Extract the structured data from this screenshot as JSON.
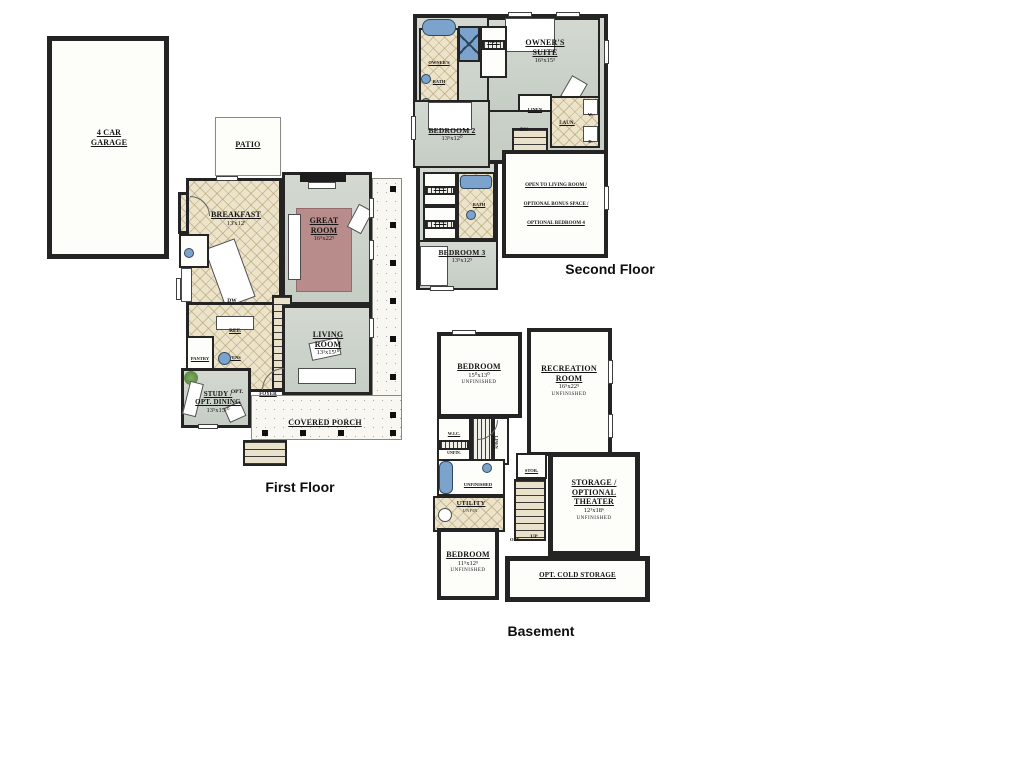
{
  "palette": {
    "wall": "#242424",
    "room_green": "#ccd3cb",
    "tile_tan": "#ece3cb",
    "rug_mauve": "#b98c8c",
    "fixture_blue": "#7ba3cc",
    "porch": "#f8f7f2"
  },
  "floors": {
    "first": {
      "title": "First Floor",
      "rooms": {
        "garage": {
          "name": "4 CAR",
          "name2": "GARAGE"
        },
        "patio": {
          "name": "PATIO"
        },
        "mud": {
          "name": "MUD"
        },
        "breakfast": {
          "name": "BREAKFAST",
          "dims": "13'x12'"
        },
        "great_room": {
          "name": "GREAT",
          "name2": "ROOM",
          "dims": "16⁵x22⁵"
        },
        "living_room": {
          "name": "LIVING",
          "name2": "ROOM",
          "dims": "13¹x15¹⁰"
        },
        "study": {
          "name": "STUDY /",
          "name2": "OPT. DINING",
          "dims": "13⁵x15¹⁰"
        },
        "covered_porch": {
          "name": "COVERED PORCH"
        },
        "foyer": {
          "name": "FOYER"
        },
        "pantry": {
          "name": "PANTRY"
        },
        "ovens": {
          "name": "OVENS"
        },
        "ref": {
          "name": "REF."
        },
        "dw": {
          "name": "DW"
        },
        "opt_door": {
          "name": "OPT."
        }
      }
    },
    "second": {
      "title": "Second Floor",
      "rooms": {
        "owners_suite": {
          "name": "OWNER'S",
          "name2": "SUITE",
          "dims": "16⁵x15⁵"
        },
        "owners_bath": {
          "name": "OWNER'S",
          "name2": "BATH"
        },
        "wic": {
          "name": "W.I.C."
        },
        "bedroom2": {
          "name": "BEDROOM 2",
          "dims": "13⁵x12⁰"
        },
        "bath": {
          "name": "BATH"
        },
        "bedroom3": {
          "name": "BEDROOM 3",
          "dims": "13⁵x12⁵"
        },
        "linen": {
          "name": "LINEN"
        },
        "laundry": {
          "name": "LAUN.",
          "washer": "W.",
          "dryer": "D."
        },
        "stairs_dn": {
          "name": "DN"
        },
        "bonus_note": {
          "line1": "OPEN TO LIVING ROOM /",
          "line2": "OPTIONAL BONUS SPACE /",
          "line3": "OPTIONAL BEDROOM 4"
        }
      }
    },
    "basement": {
      "title": "Basement",
      "rooms": {
        "bedroom1": {
          "name": "BEDROOM",
          "dims": "15⁰x13⁰",
          "sub": "UNFINISHED"
        },
        "rec_room": {
          "name": "RECREATION",
          "name2": "ROOM",
          "dims": "16⁵x22⁵",
          "sub": "UNFINISHED"
        },
        "wic": {
          "name": "W.I.C.",
          "sub": "UNFIN."
        },
        "linen": {
          "name": "LINEN"
        },
        "bath": {
          "name": "UNFINISHED",
          "name2": "BATH"
        },
        "utility": {
          "name": "UTILITY",
          "sub": "UNFIN."
        },
        "storage": {
          "name": "STOR."
        },
        "stairs_up": {
          "name": "UP"
        },
        "opt_door": {
          "name": "OPT."
        },
        "theater": {
          "name": "STORAGE /",
          "name2": "OPTIONAL",
          "name3": "THEATER",
          "dims": "12¹x18⁶",
          "sub": "UNFINISHED"
        },
        "bedroom2": {
          "name": "BEDROOM",
          "dims": "11⁵x12⁵",
          "sub": "UNFINISHED"
        },
        "cold_storage": {
          "name": "OPT. COLD STORAGE"
        }
      }
    }
  }
}
